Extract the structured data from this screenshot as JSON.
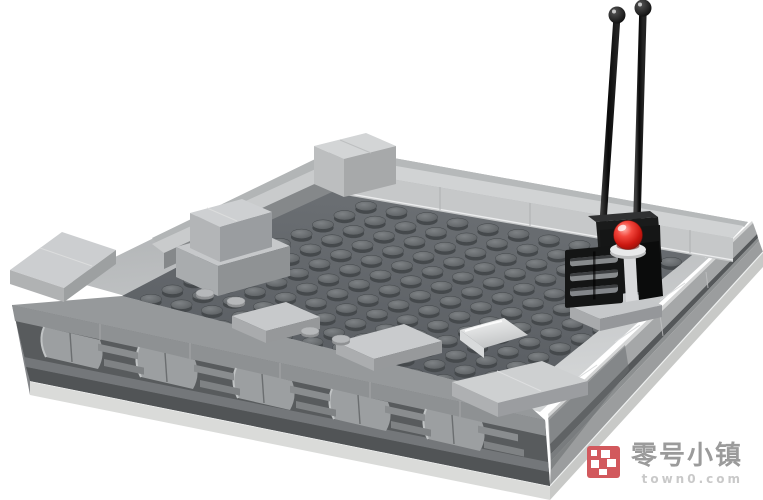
{
  "image": {
    "type": "product photo on plain white background",
    "subject": "Light-gray LEGO micro-scale building platform with a dark studded deck, smooth tile perimeter walls, a greebled stone-like front facade, and a black sensor unit carrying two tall antennas and a translucent red beacon light",
    "background_color": "#ffffff"
  },
  "model": {
    "antenna_count": 2,
    "parts": [
      {
        "name": "baseplate-slab",
        "color": "#d8d9d7"
      },
      {
        "name": "studded-deck",
        "color": "#62666b"
      },
      {
        "name": "perimeter-wall-tiles",
        "color": "#cdd0d1"
      },
      {
        "name": "front-facade-greebles",
        "color": "#8e9193"
      },
      {
        "name": "corner-tile-stack",
        "color": "#c6c8ca"
      },
      {
        "name": "white-curved-slope",
        "color": "#f2f3f3"
      },
      {
        "name": "antenna-rods",
        "color": "#111111"
      },
      {
        "name": "beacon-dome",
        "color": "#d21a12"
      },
      {
        "name": "beacon-base-plate",
        "color": "#e8e9ea"
      },
      {
        "name": "grille-brick",
        "color": "#141515"
      }
    ]
  },
  "watermark": {
    "brand": "零号小镇",
    "domain": "town0.com",
    "icon_color": "#d2595d",
    "brand_color": "#9b9b9b",
    "domain_color": "#c9c9c9"
  }
}
